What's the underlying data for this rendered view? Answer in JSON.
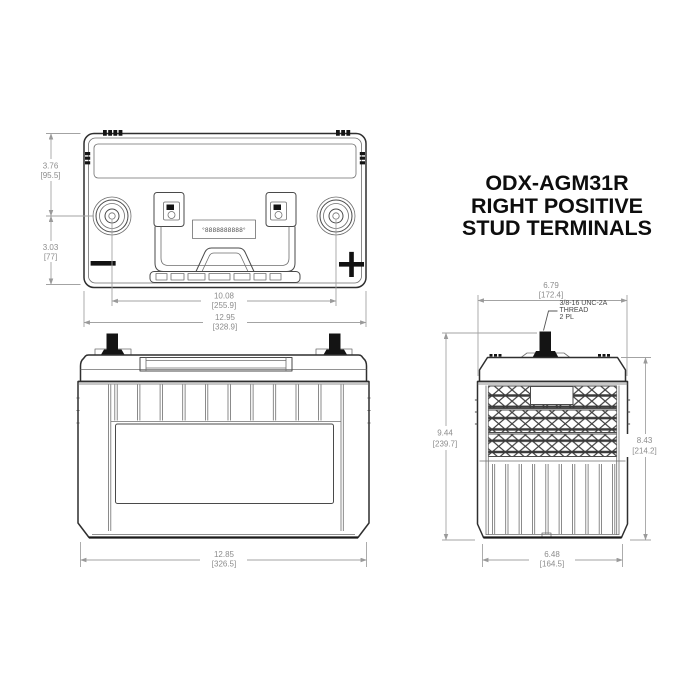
{
  "title": {
    "lines": [
      "ODX-AGM31R",
      "RIGHT POSITIVE",
      "STUD TERMINALS"
    ]
  },
  "polarity": {
    "negative": "−",
    "positive": "+"
  },
  "stamp": "°8888888888°",
  "terminal_callout": {
    "lines": [
      "3/8-16 UNC-2A",
      "THREAD",
      "2 PL"
    ]
  },
  "dims": {
    "edge_to_terminal": {
      "in": "3.76",
      "mm": "[95.5]"
    },
    "terminal_to_edge": {
      "in": "3.03",
      "mm": "[77]"
    },
    "terminal_spacing": {
      "in": "10.08",
      "mm": "[255.9]"
    },
    "top_overall_length": {
      "in": "12.95",
      "mm": "[328.9]"
    },
    "front_overall_length": {
      "in": "12.85",
      "mm": "[326.5]"
    },
    "side_overall_width": {
      "in": "6.79",
      "mm": "[172.4]"
    },
    "overall_height": {
      "in": "9.44",
      "mm": "[239.7]"
    },
    "case_height": {
      "in": "8.43",
      "mm": "[214.2]"
    },
    "side_bottom_width": {
      "in": "6.48",
      "mm": "[164.5]"
    }
  },
  "colors": {
    "line": "#2f2f2f",
    "dimension": "#a3a3a3",
    "dimension_text": "#8c8c8c",
    "terminal_fill": "#141414",
    "background": "#ffffff"
  }
}
